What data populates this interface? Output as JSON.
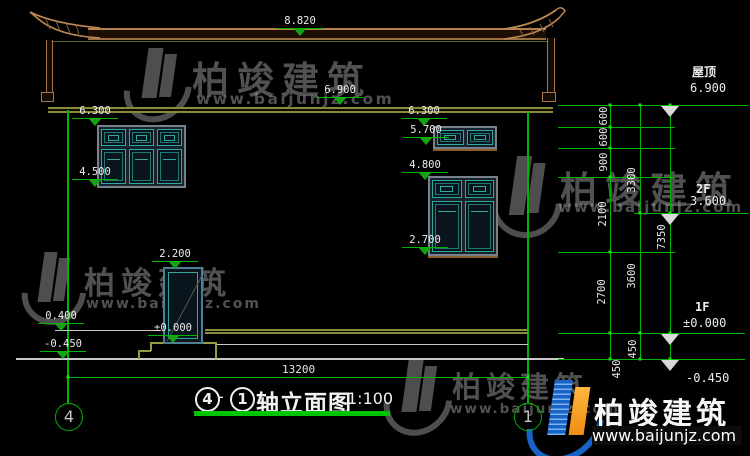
{
  "title": {
    "axis_left": "4",
    "separator": "-",
    "axis_right": "1",
    "name": "轴立面图",
    "scale": "1:100"
  },
  "grid": {
    "left_bubble": "4",
    "right_bubble": "1"
  },
  "levels": {
    "ridge": "8.820",
    "eave": "6.900",
    "wall_top_left": "6.300",
    "window_sill_left": "4.500",
    "wall_top_right": "6.300",
    "upper_window_sill": "5.700",
    "window_head_right": "4.800",
    "window_sill_right": "2.700",
    "door_head": "2.200",
    "door_floor": "±0.000",
    "plinth": "0.400",
    "ground_left": "-0.450"
  },
  "right_levels": [
    {
      "label": "屋顶",
      "value": "6.900"
    },
    {
      "label": "2F",
      "value": "3.600"
    },
    {
      "label": "1F",
      "value": "±0.000"
    },
    {
      "label": "",
      "value": "-0.450"
    }
  ],
  "dimensions": {
    "overall_width": "13200",
    "chain_inner": [
      "600",
      "600",
      "900",
      "2100",
      "2700",
      "450"
    ],
    "chain_floor": [
      "3300",
      "3600",
      "450"
    ],
    "chain_total": [
      "7350"
    ]
  },
  "watermark": {
    "brand": "柏竣建筑",
    "url": "www.baijunjz.com"
  },
  "colors": {
    "dim_green": "#00b400",
    "roof_tan": "#b5824e",
    "wall_olive": "#8a8a3c",
    "window_teal": "#2fa8a0",
    "logo_blue": "#1763c6",
    "logo_orange": "#f5a623"
  }
}
